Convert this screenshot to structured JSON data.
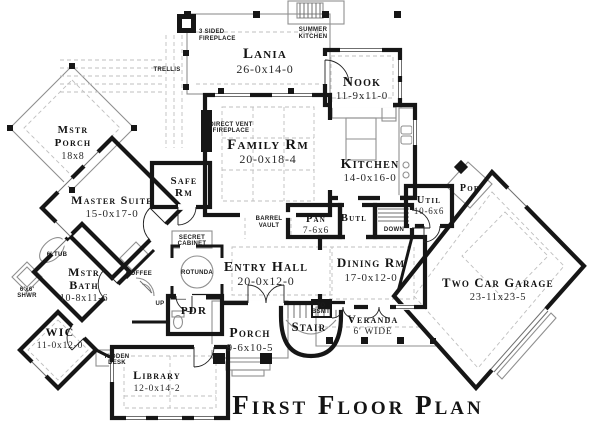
{
  "title": "First Floor Plan",
  "colors": {
    "wall": "#161616",
    "thin_line": "#8f8f8f",
    "dashed_line": "#bfbfbf",
    "background": "#ffffff"
  },
  "rooms": {
    "lania": {
      "name": "Lania",
      "dims": "26-0x14-0"
    },
    "nook": {
      "name": "Nook",
      "dims": "11-9x11-0"
    },
    "family": {
      "name": "Family Rm",
      "dims": "20-0x18-4"
    },
    "kitchen": {
      "name": "Kitchen",
      "dims": "14-0x16-0"
    },
    "safe": {
      "name": "Safe",
      "name2": "Rm"
    },
    "mstr_porch": {
      "name": "Mstr",
      "name2": "Porch",
      "dims": "18x8"
    },
    "master": {
      "name": "Master Suite",
      "dims": "15-0x17-0"
    },
    "bath": {
      "name": "Mstr",
      "name2": "Bath",
      "dims": "10-8x11-6"
    },
    "wic": {
      "name": "WIC",
      "dims": "11-0x12-0"
    },
    "pan": {
      "name": "Pan",
      "dims": "7-6x6"
    },
    "butl": {
      "name": "Butl"
    },
    "util": {
      "name": "Util",
      "dims": "10-6x6"
    },
    "por": {
      "name": "Por"
    },
    "entry": {
      "name": "Entry Hall",
      "dims": "20-0x12-0"
    },
    "dining": {
      "name": "Dining Rm",
      "dims": "17-0x12-0"
    },
    "garage": {
      "name": "Two Car Garage",
      "dims": "23-11x23-5"
    },
    "porch": {
      "name": "Porch",
      "dims": "9-6x10-5"
    },
    "stair": {
      "name": "Stair"
    },
    "veranda": {
      "name": "Veranda",
      "dims": "6' WIDE"
    },
    "library": {
      "name": "Library",
      "dims": "12-0x14-2"
    },
    "pdr": {
      "name": "PDR"
    }
  },
  "annotations": {
    "trellis": "TRELLIS",
    "fp3_1": "3 SIDED",
    "fp3_2": "FIREPLACE",
    "summer1": "SUMMER",
    "summer2": "KITCHEN",
    "vent1": "DIRECT VENT",
    "vent2": "FIREPLACE",
    "barrel1": "BARREL",
    "barrel2": "VAULT",
    "secret1": "SECRET",
    "secret2": "CABINET",
    "rotunda": "ROTUNDA",
    "coffee": "COFFEE",
    "up": "UP",
    "down": "DOWN",
    "tobsmt1": "TO",
    "tobsmt2": "BSMT",
    "tub": "6' TUB",
    "shwr1": "6'x6'",
    "shwr2": "SHWR",
    "desk1": "HIDDEN",
    "desk2": "DESK"
  }
}
